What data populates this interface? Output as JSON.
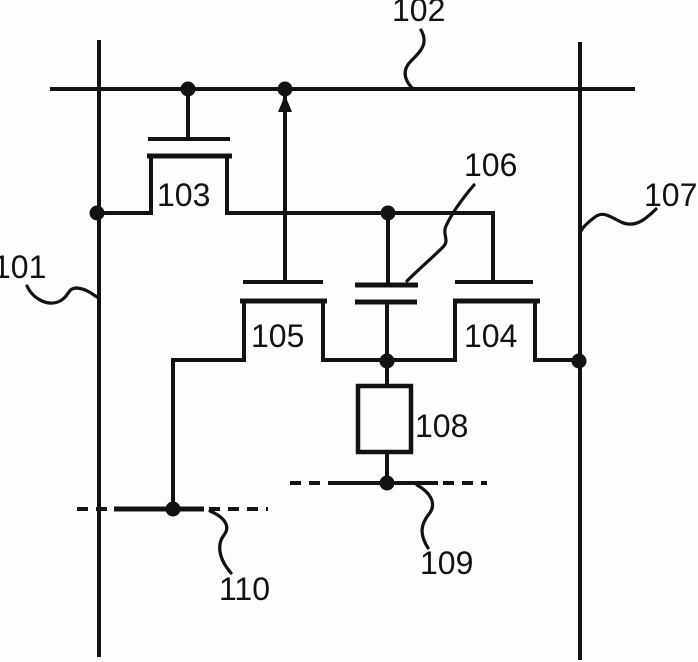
{
  "schematic": {
    "canvas": {
      "width": 698,
      "height": 662,
      "background": "#fdfdfc",
      "ink": "#121212"
    },
    "stroke": {
      "wire": 4,
      "bar": 5,
      "leader": 3.2,
      "dash_pattern": "11 8",
      "dot_radius": 7.5,
      "box": 4.5
    },
    "text": {
      "size": 32,
      "color": "#121212"
    },
    "labels": [
      {
        "text": "101",
        "x": -7,
        "y": 278
      },
      {
        "text": "102",
        "x": 392,
        "y": 21
      },
      {
        "text": "103",
        "x": 157,
        "y": 206
      },
      {
        "text": "104",
        "x": 464,
        "y": 347
      },
      {
        "text": "105",
        "x": 251,
        "y": 347
      },
      {
        "text": "106",
        "x": 464,
        "y": 176
      },
      {
        "text": "107",
        "x": 644,
        "y": 206
      },
      {
        "text": "108",
        "x": 415,
        "y": 437
      },
      {
        "text": "109",
        "x": 420,
        "y": 574
      },
      {
        "text": "110",
        "x": 219,
        "y": 600
      }
    ],
    "wires": [
      {
        "name": "top-horizontal-bus-102",
        "x1": 50,
        "y1": 89,
        "x2": 635,
        "y2": 89,
        "w": 4
      },
      {
        "name": "left-vertical-bus-101",
        "x1": 99,
        "y1": 40,
        "x2": 99,
        "y2": 657,
        "w": 4
      },
      {
        "name": "right-vertical-bus-107",
        "x1": 580,
        "y1": 42,
        "x2": 580,
        "y2": 660,
        "w": 4
      },
      {
        "name": "t103-gate-lead",
        "x1": 188,
        "y1": 89,
        "x2": 188,
        "y2": 139,
        "w": 4
      },
      {
        "name": "t103-gate-bar",
        "x1": 148,
        "y1": 139,
        "x2": 230,
        "y2": 139,
        "w": 4
      },
      {
        "name": "t103-channel-bar",
        "x1": 147,
        "y1": 156,
        "x2": 232,
        "y2": 156,
        "w": 5
      },
      {
        "name": "t103-left-leg",
        "x1": 151,
        "y1": 156,
        "x2": 151,
        "y2": 213,
        "w": 4
      },
      {
        "name": "wire-leftbus-to-t103",
        "x1": 97,
        "y1": 213,
        "x2": 153,
        "y2": 213,
        "w": 4
      },
      {
        "name": "t103-right-leg",
        "x1": 227,
        "y1": 156,
        "x2": 227,
        "y2": 213,
        "w": 4
      },
      {
        "name": "wire-t103-to-t104-gate",
        "x1": 225,
        "y1": 213,
        "x2": 493,
        "y2": 213,
        "w": 4
      },
      {
        "name": "t105-gate-lead",
        "x1": 285,
        "y1": 89,
        "x2": 285,
        "y2": 283,
        "w": 4
      },
      {
        "name": "t105-gate-bar",
        "x1": 243,
        "y1": 282,
        "x2": 323,
        "y2": 282,
        "w": 4
      },
      {
        "name": "t105-channel-bar",
        "x1": 240,
        "y1": 301,
        "x2": 327,
        "y2": 301,
        "w": 5
      },
      {
        "name": "t105-left-leg",
        "x1": 244,
        "y1": 301,
        "x2": 244,
        "y2": 360,
        "w": 4
      },
      {
        "name": "t105-right-leg",
        "x1": 323,
        "y1": 301,
        "x2": 323,
        "y2": 360,
        "w": 4
      },
      {
        "name": "wire-t105-left",
        "x1": 173,
        "y1": 360,
        "x2": 246,
        "y2": 360,
        "w": 4
      },
      {
        "name": "wire-drop-to-row110",
        "x1": 173,
        "y1": 358,
        "x2": 173,
        "y2": 511,
        "w": 4
      },
      {
        "name": "wire-t105-to-t104",
        "x1": 321,
        "y1": 360,
        "x2": 457,
        "y2": 360,
        "w": 4
      },
      {
        "name": "cap106-top-lead",
        "x1": 388,
        "y1": 213,
        "x2": 388,
        "y2": 285,
        "w": 4
      },
      {
        "name": "cap106-top-plate",
        "x1": 355,
        "y1": 285,
        "x2": 418,
        "y2": 285,
        "w": 5
      },
      {
        "name": "cap106-bottom-plate",
        "x1": 355,
        "y1": 302,
        "x2": 417,
        "y2": 302,
        "w": 5
      },
      {
        "name": "cap106-bottom-lead",
        "x1": 387,
        "y1": 302,
        "x2": 387,
        "y2": 361,
        "w": 4
      },
      {
        "name": "t104-gate-lead",
        "x1": 493,
        "y1": 211,
        "x2": 493,
        "y2": 282,
        "w": 4
      },
      {
        "name": "t104-gate-bar",
        "x1": 455,
        "y1": 282,
        "x2": 533,
        "y2": 282,
        "w": 4
      },
      {
        "name": "t104-channel-bar",
        "x1": 453,
        "y1": 301,
        "x2": 540,
        "y2": 301,
        "w": 5
      },
      {
        "name": "t104-left-leg",
        "x1": 455,
        "y1": 301,
        "x2": 455,
        "y2": 360,
        "w": 4
      },
      {
        "name": "t104-right-leg",
        "x1": 535,
        "y1": 301,
        "x2": 535,
        "y2": 360,
        "w": 4
      },
      {
        "name": "wire-t104-to-rightbus",
        "x1": 533,
        "y1": 360,
        "x2": 580,
        "y2": 360,
        "w": 4
      },
      {
        "name": "box108-top-lead",
        "x1": 387,
        "y1": 360,
        "x2": 387,
        "y2": 388,
        "w": 4
      },
      {
        "name": "box108-bottom-lead",
        "x1": 387,
        "y1": 451,
        "x2": 387,
        "y2": 484,
        "w": 4
      },
      {
        "name": "row109-solid-segment",
        "x1": 333,
        "y1": 483,
        "x2": 438,
        "y2": 483,
        "w": 4
      },
      {
        "name": "row110-solid-segment",
        "x1": 114,
        "y1": 509,
        "x2": 204,
        "y2": 509,
        "w": 5
      }
    ],
    "dashed_wires": [
      {
        "name": "row109-dash-left",
        "x1": 290,
        "y1": 483,
        "x2": 333,
        "y2": 483,
        "w": 4
      },
      {
        "name": "row109-dash-right",
        "x1": 443,
        "y1": 483,
        "x2": 487,
        "y2": 483,
        "w": 4
      },
      {
        "name": "row110-dash-left",
        "x1": 77,
        "y1": 509,
        "x2": 114,
        "y2": 509,
        "w": 4
      },
      {
        "name": "row110-dash-right",
        "x1": 209,
        "y1": 509,
        "x2": 268,
        "y2": 509,
        "w": 4
      }
    ],
    "junction_dots": [
      {
        "x": 188,
        "y": 89
      },
      {
        "x": 285,
        "y": 89
      },
      {
        "x": 97,
        "y": 213
      },
      {
        "x": 388,
        "y": 213
      },
      {
        "x": 387,
        "y": 361
      },
      {
        "x": 579,
        "y": 361
      },
      {
        "x": 387,
        "y": 483
      },
      {
        "x": 173,
        "y": 509
      }
    ],
    "direction_arrow": {
      "name": "up-arrowhead",
      "points": "285,95 278,112 292,112"
    },
    "element_box": {
      "name": "element-box-108",
      "x": 358,
      "y": 386,
      "width": 53,
      "height": 66
    },
    "leader_lines": [
      {
        "name": "leader-102",
        "d": "M 421 30 C 429 44 420 52 411 61 C 403 69 403 78 412 88"
      },
      {
        "name": "leader-101",
        "d": "M 27 286 C 33 299 48 307 60 301 C 70 296 67 288 77 288 C 87 289 92 294 97 297"
      },
      {
        "name": "leader-106",
        "d": "M 474 185 C 462 199 452 213 446 226 C 442 235 450 240 443 247 C 433 257 419 269 407 281"
      },
      {
        "name": "leader-107",
        "d": "M 656 209 C 644 221 634 228 621 222 C 609 216 603 211 595 217 C 587 223 583 227 581 231"
      },
      {
        "name": "leader-109",
        "d": "M 417 485 C 431 493 437 504 429 514 C 421 524 419 534 428 548"
      },
      {
        "name": "leader-110",
        "d": "M 210 511 C 224 517 231 526 224 535 C 217 544 218 558 231 573"
      }
    ]
  }
}
